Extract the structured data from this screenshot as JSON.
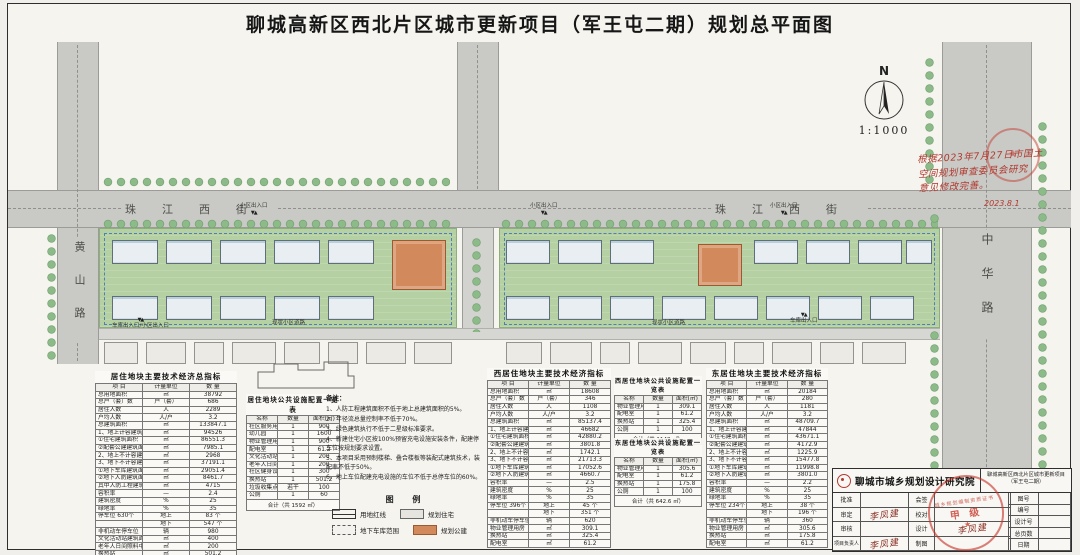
{
  "title": "聊城高新区西北片区城市更新项目（军王屯二期）规划总平面图",
  "north": {
    "label": "N",
    "scale": "1:1000"
  },
  "annotation": {
    "lines": [
      "根据2023年7月27日市国土",
      "空间规划审查委员会研究",
      "意见修改完善。"
    ],
    "date": "2023.8.1"
  },
  "roads": {
    "street": "珠江西街",
    "huangshan": "黄山路",
    "zhonghua": "中华路"
  },
  "entrances": {
    "gate": "小区出入口",
    "garage": "车库出入口",
    "garage_gate": "车库出入口/小区出入口",
    "existing_road": "现状小区道路",
    "marker": "▼▲"
  },
  "legend": {
    "title": "图 例",
    "items": [
      {
        "name": "redline",
        "label": "用地红线"
      },
      {
        "name": "residential",
        "label": "规划住宅"
      },
      {
        "name": "garage",
        "label": "地下车库范围"
      },
      {
        "name": "public",
        "label": "规划公建"
      }
    ]
  },
  "tables": {
    "total": {
      "title": "居住地块主要技术经济总指标",
      "columns": [
        "项 目",
        "计量单位",
        "数 量"
      ],
      "rows": [
        [
          "总用地面积",
          "㎡",
          "38792"
        ],
        [
          "总户（套）数",
          "户（套）",
          "686"
        ],
        [
          "居住人数",
          "人",
          "2289"
        ],
        [
          "户均人数",
          "人/户",
          "3.2"
        ],
        [
          "总建筑面积",
          "㎡",
          "133847.1"
        ],
        [
          "1、地上计容建筑面积",
          "㎡",
          "94526"
        ],
        [
          "①住宅建筑面积",
          "㎡",
          "86551.3"
        ],
        [
          "②配套公建建筑面积",
          "㎡",
          "7985.1"
        ],
        [
          "2、地上不计容建筑面积",
          "㎡",
          "2968"
        ],
        [
          "3、地下不计容建筑面积",
          "㎡",
          "37191.1"
        ],
        [
          "①地下车库建筑面积",
          "㎡",
          "29051.4"
        ],
        [
          "②地下人防建筑面积",
          "㎡",
          "8461.7"
        ],
        [
          "其中人防工程建筑面积",
          "㎡",
          "4715"
        ],
        [
          "容积率",
          "—",
          "2.4"
        ],
        [
          "建筑密度",
          "%",
          "25"
        ],
        [
          "绿地率",
          "%",
          "35"
        ],
        [
          "停车位 630个",
          "地上",
          "83 个"
        ],
        [
          "",
          "地下",
          "547 个"
        ],
        [
          "非机动车停车位",
          "辆",
          "980"
        ],
        [
          "文化活动站建筑面积",
          "㎡",
          "400"
        ],
        [
          "老年人日间照料中心",
          "㎡",
          "200"
        ],
        [
          "换热站",
          "㎡",
          "501.2"
        ],
        [
          "公厕",
          "㎡",
          "60"
        ]
      ]
    },
    "west": {
      "title": "西居住地块主要技术经济指标",
      "columns": [
        "项 目",
        "计量单位",
        "数 量"
      ],
      "rows": [
        [
          "总用地面积",
          "㎡",
          "18608"
        ],
        [
          "总户（套）数",
          "户（套）",
          "346"
        ],
        [
          "居住人数",
          "人",
          "1108"
        ],
        [
          "户均人数",
          "人/户",
          "3.2"
        ],
        [
          "总建筑面积",
          "㎡",
          "85137.4"
        ],
        [
          "1、地上计容建筑面积",
          "㎡",
          "46682"
        ],
        [
          "①住宅建筑面积",
          "㎡",
          "42880.2"
        ],
        [
          "②配套公建建筑面积",
          "㎡",
          "3801.8"
        ],
        [
          "2、地上不计容建筑面积",
          "㎡",
          "1742.1"
        ],
        [
          "3、地下不计容建筑面积",
          "㎡",
          "21713.3"
        ],
        [
          "①地下车库建筑面积",
          "㎡",
          "17052.6"
        ],
        [
          "②地下人防建筑面积",
          "㎡",
          "4660.7"
        ],
        [
          "容积率",
          "—",
          "2.5"
        ],
        [
          "建筑密度",
          "%",
          "25"
        ],
        [
          "绿地率",
          "%",
          "35"
        ],
        [
          "停车位 396个",
          "地上",
          "45 个"
        ],
        [
          "",
          "地下",
          "351 个"
        ],
        [
          "非机动车停车位",
          "辆",
          "620"
        ],
        [
          "物业管理用房",
          "㎡",
          "309.1"
        ],
        [
          "换热站",
          "㎡",
          "325.4"
        ],
        [
          "配电室",
          "㎡",
          "61.2"
        ]
      ]
    },
    "east": {
      "title": "东居住地块主要技术经济指标",
      "columns": [
        "项 目",
        "计量单位",
        "数 量"
      ],
      "rows": [
        [
          "总用地面积",
          "㎡",
          "20184"
        ],
        [
          "总户（套）数",
          "户（套）",
          "280"
        ],
        [
          "居住人数",
          "人",
          "1181"
        ],
        [
          "户均人数",
          "人/户",
          "3.2"
        ],
        [
          "总建筑面积",
          "㎡",
          "48709.7"
        ],
        [
          "1、地上计容建筑面积",
          "㎡",
          "47844"
        ],
        [
          "①住宅建筑面积",
          "㎡",
          "43671.1"
        ],
        [
          "②配套公建建筑面积",
          "㎡",
          "4172.9"
        ],
        [
          "2、地上不计容建筑面积",
          "㎡",
          "1225.9"
        ],
        [
          "3、地下不计容建筑面积",
          "㎡",
          "15477.8"
        ],
        [
          "①地下车库建筑面积",
          "㎡",
          "11998.8"
        ],
        [
          "②地下人防建筑面积",
          "㎡",
          "3801.0"
        ],
        [
          "容积率",
          "—",
          "2.2"
        ],
        [
          "建筑密度",
          "%",
          "25"
        ],
        [
          "绿地率",
          "%",
          "35"
        ],
        [
          "停车位 234个",
          "地上",
          "38 个"
        ],
        [
          "",
          "地下",
          "196 个"
        ],
        [
          "非机动车停车位",
          "辆",
          "360"
        ],
        [
          "物业管理用房",
          "㎡",
          "305.6"
        ],
        [
          "换热站",
          "㎡",
          "175.8"
        ],
        [
          "配电室",
          "㎡",
          "61.2"
        ]
      ]
    },
    "facilities_total": {
      "title": "居住地块公共设施配置一览表",
      "columns": [
        "名称",
        "数量",
        "面积(㎡)"
      ],
      "rows": [
        [
          "社区服务用房",
          "1",
          "900"
        ],
        [
          "幼儿园",
          "1",
          "1600"
        ],
        [
          "物业管理用房",
          "1",
          "900"
        ],
        [
          "配电室",
          "1",
          "61.2"
        ],
        [
          "文化活动站",
          "1",
          "200"
        ],
        [
          "老年人日间照料中心",
          "1",
          "200"
        ],
        [
          "社区健身设施",
          "1",
          "300"
        ],
        [
          "换热站",
          "1",
          "501.2"
        ],
        [
          "垃圾收集点",
          "若干",
          "100"
        ],
        [
          "公厕",
          "1",
          "60"
        ]
      ],
      "footer": "合计（共 1592 ㎡）"
    },
    "facilities_west": {
      "title": "西居住地块公共设施配置一览表",
      "columns": [
        "名称",
        "数量",
        "面积(㎡)"
      ],
      "rows": [
        [
          "物业管理用房",
          "1",
          "309.1"
        ],
        [
          "配电室",
          "1",
          "61.2"
        ],
        [
          "换热站",
          "1",
          "325.4"
        ],
        [
          "公厕",
          "1",
          "100"
        ]
      ],
      "footer": "合计（共 1148 ㎡）"
    },
    "facilities_east": {
      "title": "东居住地块公共设施配置一览表",
      "columns": [
        "名称",
        "数量",
        "面积(㎡)"
      ],
      "rows": [
        [
          "物业管理用房",
          "1",
          "305.6"
        ],
        [
          "配电室",
          "1",
          "61.2"
        ],
        [
          "换热站",
          "1",
          "175.8"
        ],
        [
          "公厕",
          "1",
          "100"
        ]
      ],
      "footer": "合计（共 642.6 ㎡）"
    }
  },
  "notes": {
    "title": "备注：",
    "items": [
      "1、人防工程建筑面积不低于地上总建筑面积的5%。",
      "2、年径流总量控制率不低于70%。",
      "3、绿色建筑执行不低于二星级标准要求。",
      "4、新建住宅小区按100%预留充电设施安装条件，配建停车位按规划要求设置。",
      "5、本项目采用预制楼梯、叠合楼板等装配式建筑技术，装配率不低于50%。",
      "6、地上车位配建充电设施的车位不低于总停车位的60%。"
    ]
  },
  "titleblock": {
    "institute": "聊城市城乡规划设计研究院",
    "project_line1": "聊城高新区西北片区城市更新项目",
    "project_line2": "（军王屯二期）",
    "left_labels": [
      "批准",
      "审定",
      "审核",
      "项目负责人"
    ],
    "mid_labels": [
      "会签",
      "校对",
      "设计",
      "制图"
    ],
    "right_labels": [
      "图号",
      "编号",
      "设计号",
      "总页数",
      "日期"
    ],
    "signature": "李凤建",
    "stamp_ring": "城乡规划编制资质证书",
    "stamp_grade": "甲 级",
    "stamp_star": "★"
  },
  "colors": {
    "road": "#c9c9c5",
    "lawn": "#b5d0a2",
    "tree": "#8cba89",
    "public_building": "#d28a5c",
    "garage_line": "#4f7fb3",
    "stamp_red": "#c63428",
    "handwriting_red": "#b0392f"
  }
}
